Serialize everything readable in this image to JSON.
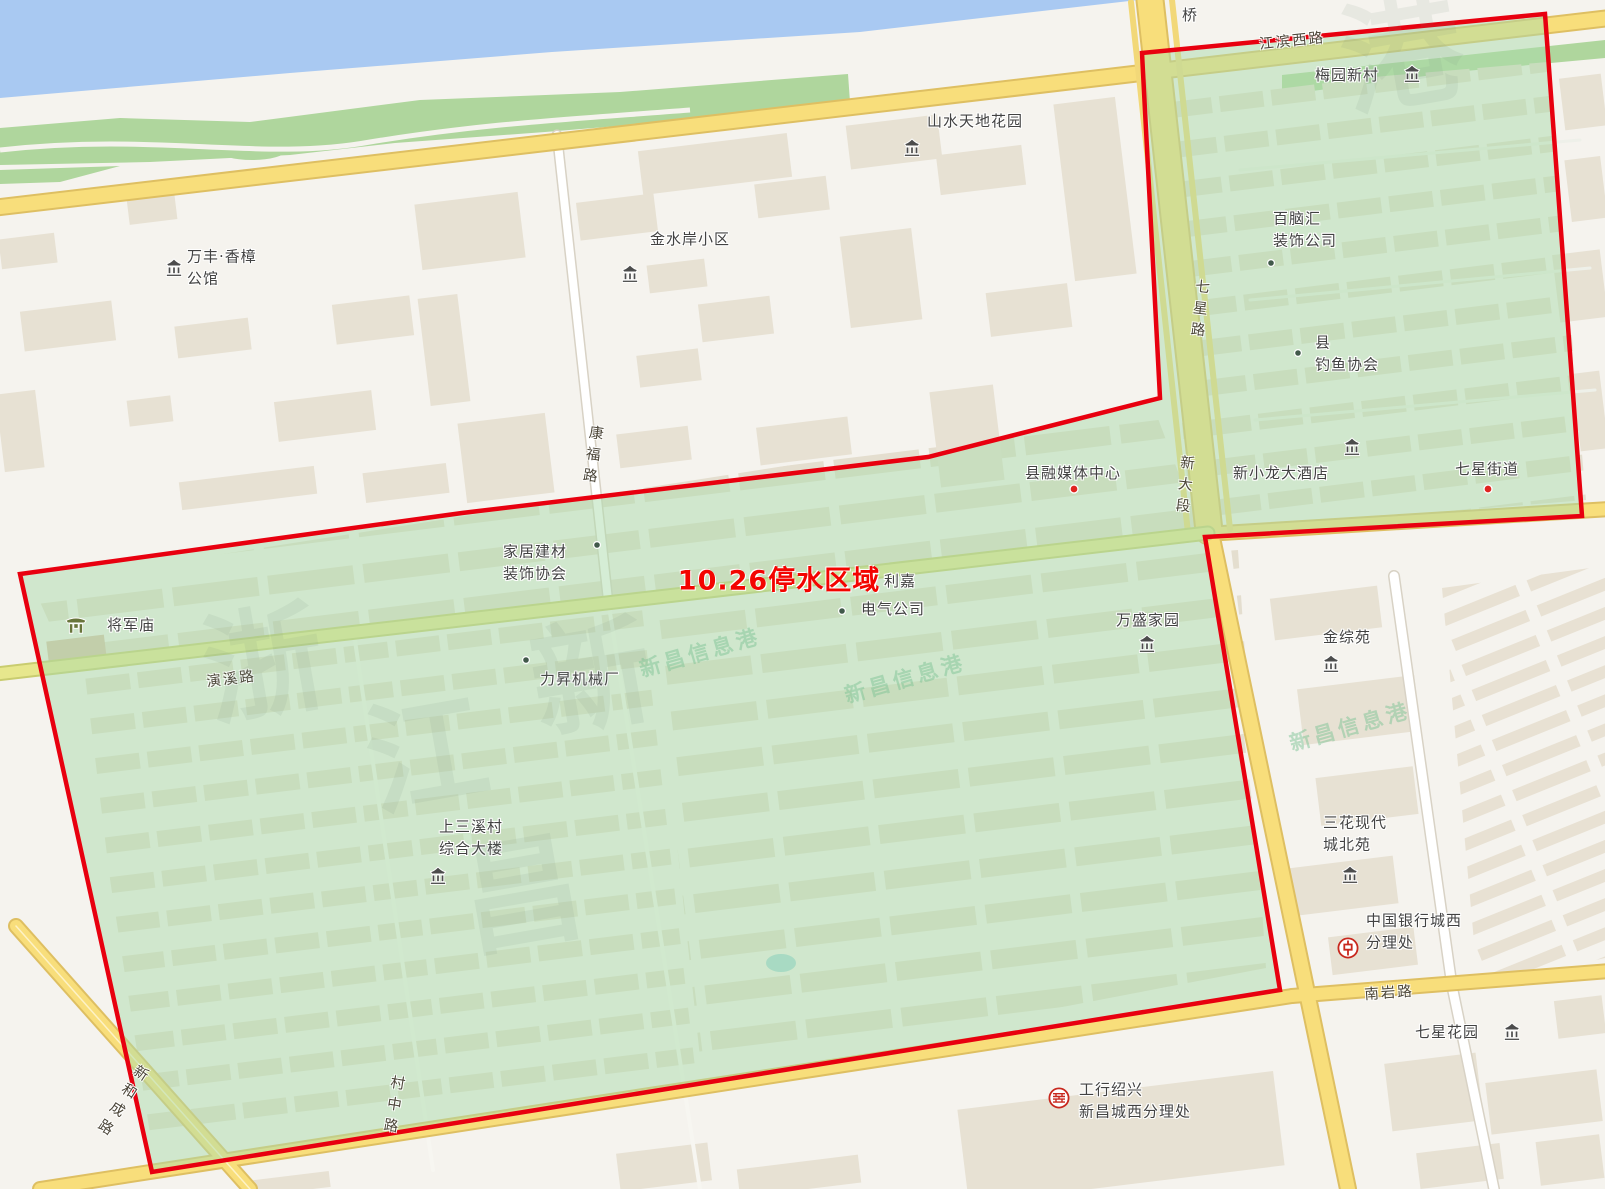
{
  "map": {
    "outage_title": "10.26停水区域",
    "colors": {
      "outage_outline": "#e8000f",
      "outage_fill": "rgba(172,219,172,0.5)",
      "water": "#a9c9f2",
      "park": "#afd69d",
      "road_yellow": "#f8de7b",
      "road_olive": "#e7e78d",
      "building_tan": "#e7e1d3"
    },
    "labels": [
      {
        "name": "label-bridge",
        "text": "桥",
        "x": 1190,
        "y": 16,
        "cls": "poi"
      },
      {
        "name": "road-jiangbin-xilu",
        "text": "江滨西路",
        "x": 1292,
        "y": 40,
        "cls": "road",
        "rot": -6
      },
      {
        "name": "label-meiyuan-xincun",
        "text": "梅园新村",
        "x": 1347,
        "y": 76,
        "cls": "poi"
      },
      {
        "name": "label-shanshui-tiandi-huayuan",
        "text": "山水天地花园",
        "x": 975,
        "y": 122,
        "cls": "poi"
      },
      {
        "name": "label-bainaohui-zhuangshi-gongsi",
        "text": "百脑汇\n装饰公司",
        "x": 1273,
        "y": 230,
        "cls": "poi",
        "align": "left"
      },
      {
        "name": "label-wanfeng-xiangzhang-gongguan",
        "text": "万丰·香樟\n公馆",
        "x": 187,
        "y": 268,
        "cls": "poi",
        "align": "left"
      },
      {
        "name": "label-jinshuian-xiaoqu",
        "text": "金水岸小区",
        "x": 690,
        "y": 240,
        "cls": "poi"
      },
      {
        "name": "road-kangfulu",
        "text": "康福路",
        "x": 592,
        "y": 457,
        "cls": "roadv",
        "rot": 8
      },
      {
        "name": "road-qixinglu",
        "text": "七星路",
        "x": 1199,
        "y": 311,
        "cls": "roadv",
        "rot": 6
      },
      {
        "name": "road-xindaduan",
        "text": "新大段",
        "x": 1184,
        "y": 487,
        "cls": "roadv",
        "rot": 6
      },
      {
        "name": "label-xian-diaoyu-xiehui",
        "text": "县\n钓鱼协会",
        "x": 1315,
        "y": 354,
        "cls": "poi",
        "align": "left"
      },
      {
        "name": "label-xian-rongmeiti-zhongxin",
        "text": "县融媒体中心",
        "x": 1073,
        "y": 474,
        "cls": "poi"
      },
      {
        "name": "label-xinxiaolong-dajiudian",
        "text": "新小龙大酒店",
        "x": 1281,
        "y": 474,
        "cls": "poi"
      },
      {
        "name": "label-qixing-jiedao",
        "text": "七星街道",
        "x": 1487,
        "y": 470,
        "cls": "poi"
      },
      {
        "name": "outage-area-title",
        "text": "10.26停水区域",
        "x": 779,
        "y": 578,
        "cls": "red-title"
      },
      {
        "name": "label-lijia",
        "text": "利嘉",
        "x": 900,
        "y": 582,
        "cls": "poi"
      },
      {
        "name": "label-dianqi-gongsi",
        "text": "电气公司",
        "x": 893,
        "y": 610,
        "cls": "poi"
      },
      {
        "name": "label-jiaju-jiancai-zhuangshi-xiehui",
        "text": "家居建材\n装饰协会",
        "x": 503,
        "y": 563,
        "cls": "poi",
        "align": "left"
      },
      {
        "name": "label-wansheng-jiayuan",
        "text": "万盛家园",
        "x": 1148,
        "y": 621,
        "cls": "poi"
      },
      {
        "name": "label-jiangjunmiao",
        "text": "将军庙",
        "x": 131,
        "y": 626,
        "cls": "poi"
      },
      {
        "name": "road-yanxilu",
        "text": "演溪路",
        "x": 231,
        "y": 678,
        "cls": "road",
        "rot": -7
      },
      {
        "name": "label-lisheng-jixiechang",
        "text": "力昇机械厂",
        "x": 580,
        "y": 680,
        "cls": "poi"
      },
      {
        "name": "label-jinzongyuan",
        "text": "金综苑",
        "x": 1347,
        "y": 638,
        "cls": "poi"
      },
      {
        "name": "label-shangsanxicun-zonghe-dalou",
        "text": "上三溪村\n综合大楼",
        "x": 439,
        "y": 838,
        "cls": "poi",
        "align": "left"
      },
      {
        "name": "label-sanhua-xiandaicheng-beiyuan",
        "text": "三花现代\n城北苑",
        "x": 1323,
        "y": 834,
        "cls": "poi",
        "align": "left"
      },
      {
        "name": "label-zhongguo-yinhang-chengxi-fenlichu",
        "text": "中国银行城西\n分理处",
        "x": 1366,
        "y": 932,
        "cls": "poi",
        "align": "left"
      },
      {
        "name": "road-nanyanlu",
        "text": "南岩路",
        "x": 1389,
        "y": 992,
        "cls": "road",
        "rot": -4
      },
      {
        "name": "label-qixing-huayuan",
        "text": "七星花园",
        "x": 1447,
        "y": 1033,
        "cls": "poi"
      },
      {
        "name": "road-cunzhonglu",
        "text": "村中路",
        "x": 393,
        "y": 1107,
        "cls": "roadv",
        "rot": 9
      },
      {
        "name": "road-xinhechenglu",
        "text": "新和成路",
        "x": 121,
        "y": 1102,
        "cls": "roadv",
        "rot": 33
      },
      {
        "name": "label-gonghang-shaoxing-xinchang-chengxi-fenlichu",
        "text": "工行绍兴\n新昌城西分理处",
        "x": 1079,
        "y": 1101,
        "cls": "poi",
        "align": "left"
      },
      {
        "name": "watermark-1",
        "text": "新昌信息港",
        "x": 700,
        "y": 652,
        "cls": "wm",
        "rot": -16
      },
      {
        "name": "watermark-2",
        "text": "新昌信息港",
        "x": 905,
        "y": 678,
        "cls": "wm",
        "rot": -16
      },
      {
        "name": "watermark-3",
        "text": "新昌信息港",
        "x": 1350,
        "y": 726,
        "cls": "wm",
        "rot": -16
      },
      {
        "name": "watermark-big-1",
        "text": "浙",
        "x": 262,
        "y": 655,
        "cls": "wmbig",
        "rot": -10
      },
      {
        "name": "watermark-big-2",
        "text": "江",
        "x": 425,
        "y": 745,
        "cls": "wmbig",
        "rot": -10
      },
      {
        "name": "watermark-big-3",
        "text": "新",
        "x": 590,
        "y": 668,
        "cls": "wmbig",
        "rot": -10
      },
      {
        "name": "watermark-big-4",
        "text": "昌",
        "x": 520,
        "y": 885,
        "cls": "wmbig",
        "rot": -10
      },
      {
        "name": "watermark-big-5",
        "text": "港",
        "x": 1400,
        "y": 45,
        "cls": "wmbig",
        "rot": -10
      }
    ],
    "markers": [
      {
        "name": "meiyuan-building-icon",
        "icon": "building",
        "x": 1412,
        "y": 74
      },
      {
        "name": "shanshui-building-icon",
        "icon": "building",
        "x": 912,
        "y": 148
      },
      {
        "name": "jinshuian-building-icon",
        "icon": "building",
        "x": 630,
        "y": 274
      },
      {
        "name": "wanfeng-building-icon",
        "icon": "building",
        "x": 174,
        "y": 268
      },
      {
        "name": "hotel-building-icon",
        "icon": "building",
        "x": 1352,
        "y": 447
      },
      {
        "name": "wansheng-building-icon",
        "icon": "building",
        "x": 1147,
        "y": 644
      },
      {
        "name": "jinzongyuan-building-icon",
        "icon": "building",
        "x": 1331,
        "y": 664
      },
      {
        "name": "sanhua-building-icon",
        "icon": "building",
        "x": 1350,
        "y": 875
      },
      {
        "name": "qixinghuayuan-building-icon",
        "icon": "building",
        "x": 1512,
        "y": 1032
      },
      {
        "name": "shangsanxi-building-icon",
        "icon": "building",
        "x": 438,
        "y": 876
      },
      {
        "name": "temple-icon",
        "icon": "temple",
        "x": 76,
        "y": 625
      },
      {
        "name": "bainaohui-dot-icon",
        "icon": "dotg",
        "x": 1271,
        "y": 263
      },
      {
        "name": "diaoyu-dot-icon",
        "icon": "dotg",
        "x": 1298,
        "y": 353
      },
      {
        "name": "jiaju-dot-icon",
        "icon": "dotg",
        "x": 597,
        "y": 545
      },
      {
        "name": "lisheng-dot-icon",
        "icon": "dotg",
        "x": 526,
        "y": 660
      },
      {
        "name": "dianqi-dot-icon",
        "icon": "dotg",
        "x": 842,
        "y": 611
      },
      {
        "name": "rongmeiti-dot-icon",
        "icon": "dotr",
        "x": 1074,
        "y": 489
      },
      {
        "name": "jiedao-dot-icon",
        "icon": "dotr",
        "x": 1488,
        "y": 489
      },
      {
        "name": "bank-of-china-icon",
        "icon": "boc",
        "x": 1348,
        "y": 948
      },
      {
        "name": "icbc-bank-icon",
        "icon": "icbc",
        "x": 1059,
        "y": 1098
      }
    ]
  }
}
